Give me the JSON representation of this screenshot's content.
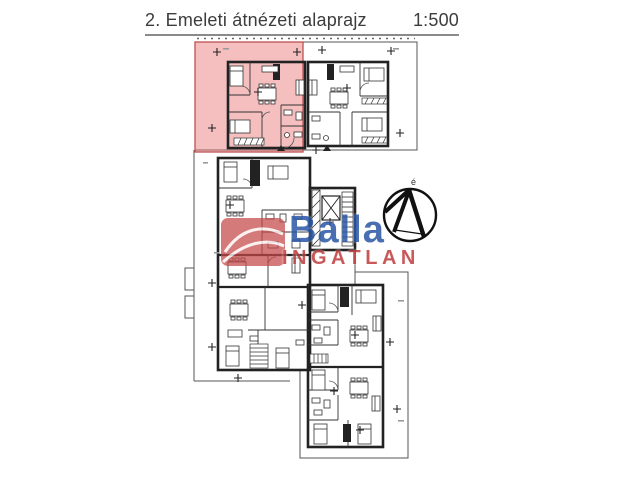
{
  "header": {
    "title": "2. Emeleti átnézeti alaprajz",
    "scale_label": "1:500"
  },
  "watermark": {
    "brand": "Balla",
    "subbrand": "INGATLAN",
    "brand_color": "#2a57a5",
    "subbrand_color": "#c03c3c",
    "emblem_color": "#c64848"
  },
  "compass": {
    "north_label": "é"
  },
  "floorplan": {
    "highlight_color": "#e87272"
  }
}
